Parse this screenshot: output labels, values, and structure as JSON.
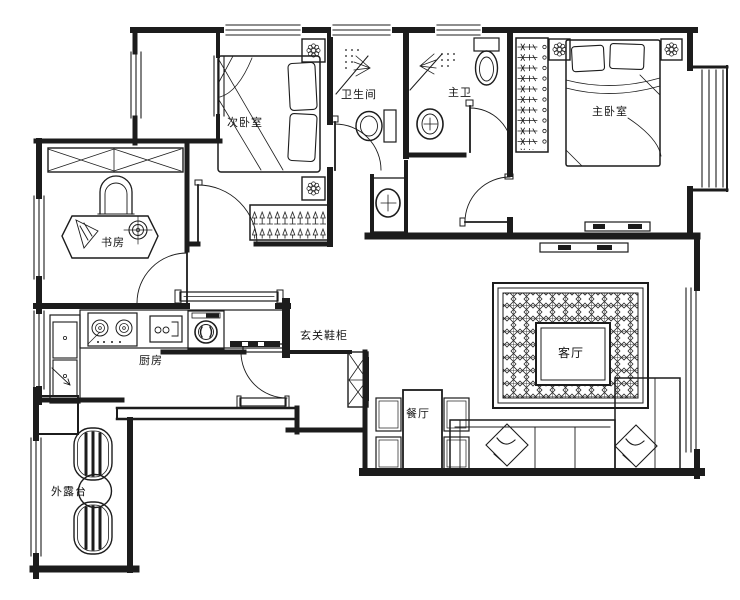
{
  "drawing": {
    "type": "apartment-floor-plan",
    "colors": {
      "line": "#1c1c1c",
      "background": "#ffffff"
    }
  },
  "rooms": [
    {
      "id": "secondary-bedroom",
      "label": "次卧室"
    },
    {
      "id": "bathroom",
      "label": "卫生间"
    },
    {
      "id": "master-bathroom",
      "label": "主卫"
    },
    {
      "id": "master-bedroom",
      "label": "主卧室"
    },
    {
      "id": "study",
      "label": "书房"
    },
    {
      "id": "kitchen",
      "label": "厨房"
    },
    {
      "id": "entry-shoe-cabinet",
      "label": "玄关鞋柜"
    },
    {
      "id": "living-room",
      "label": "客厅"
    },
    {
      "id": "dining-room",
      "label": "餐厅"
    },
    {
      "id": "terrace",
      "label": "外露台"
    }
  ]
}
